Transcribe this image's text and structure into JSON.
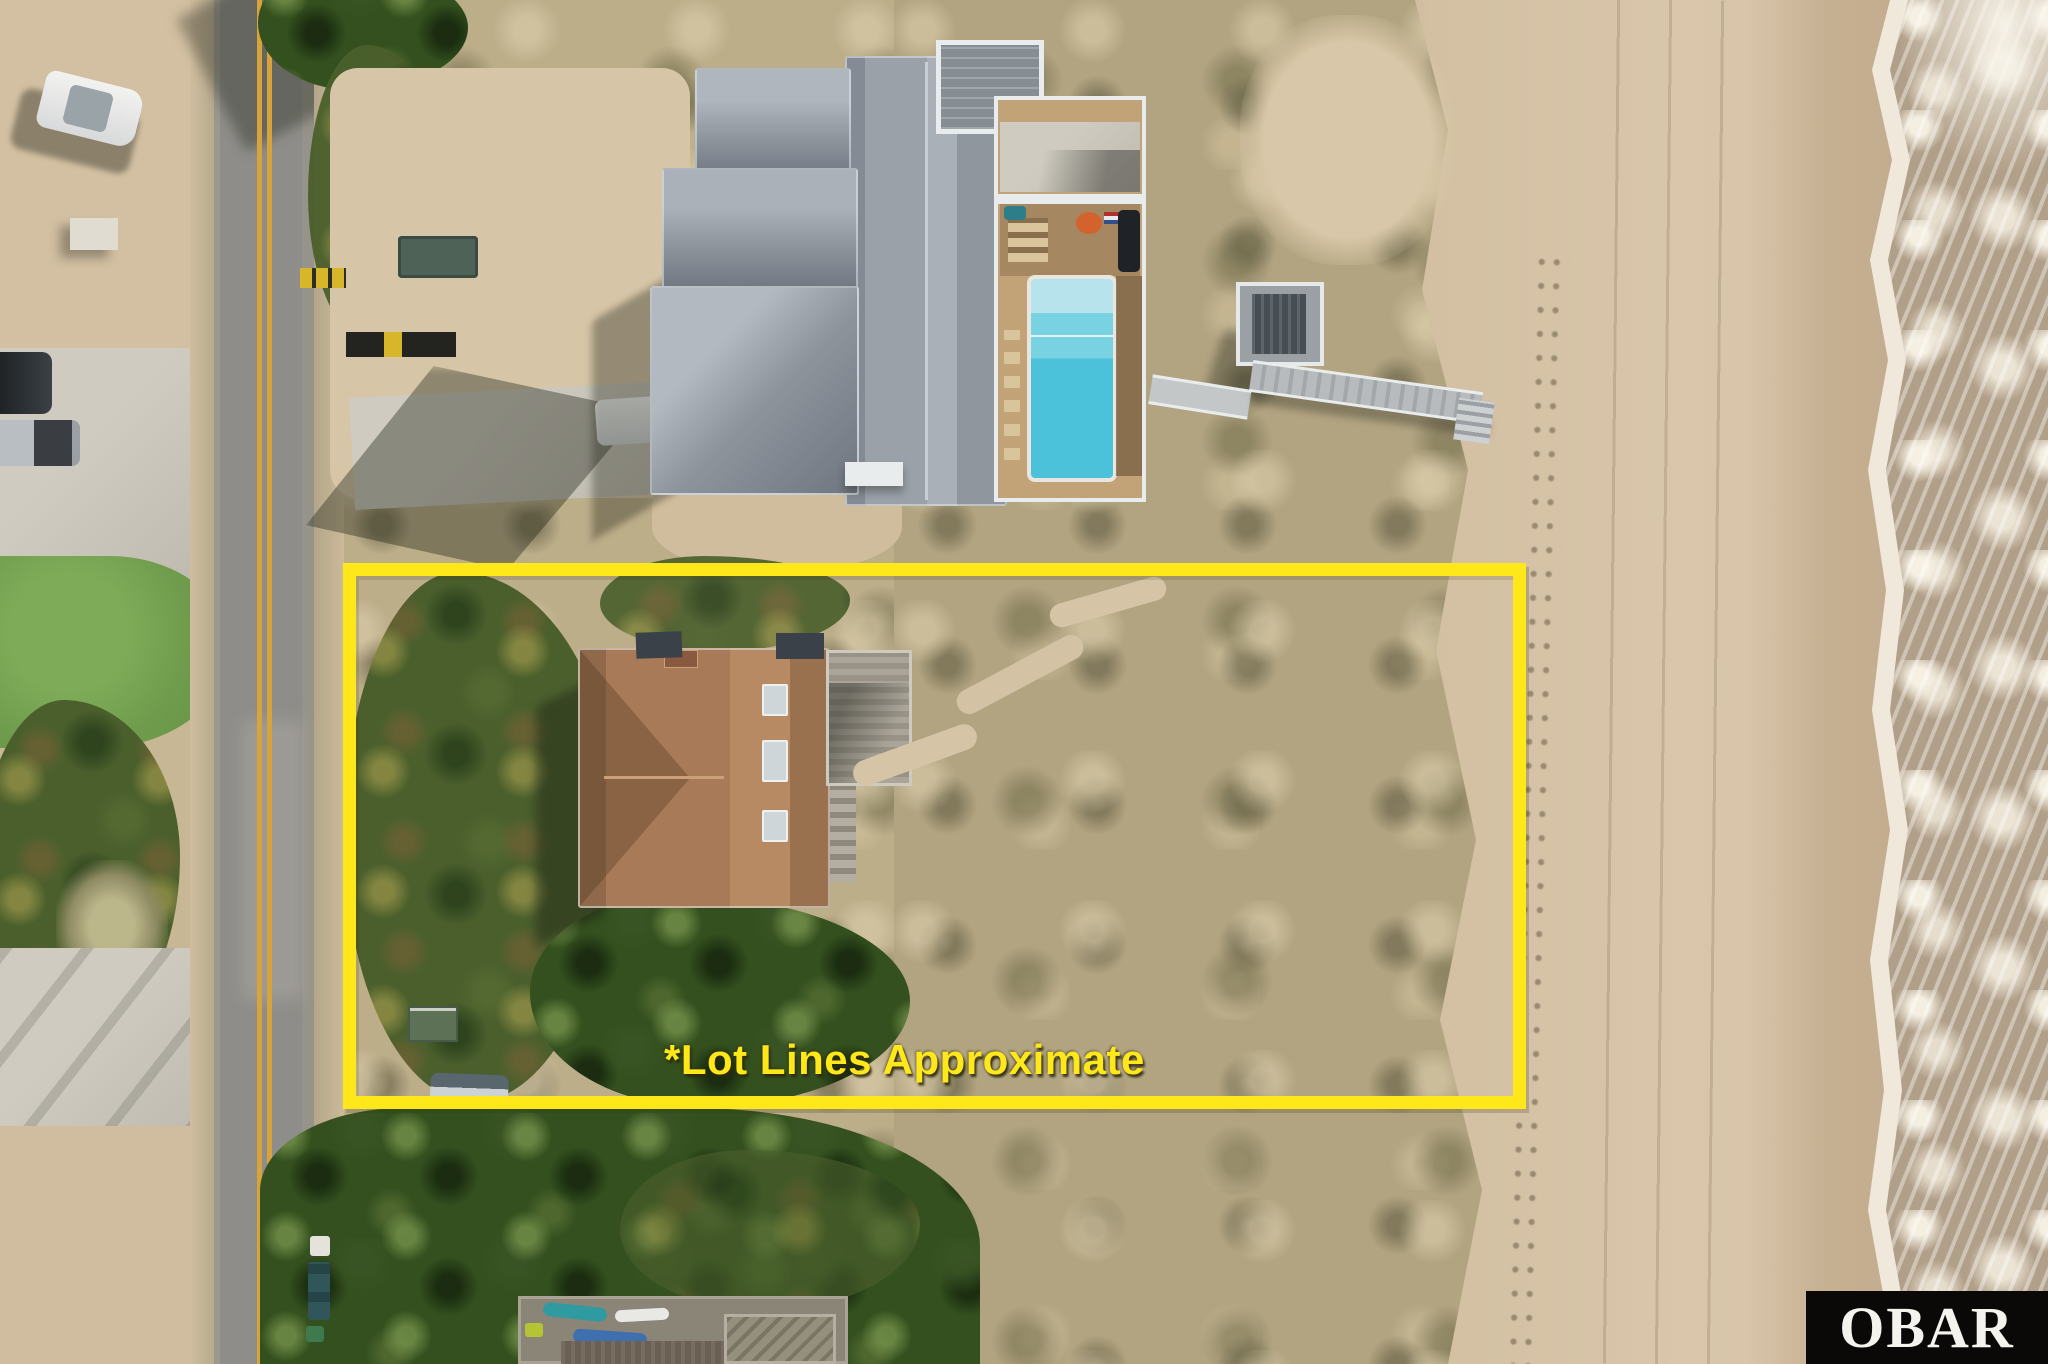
{
  "annotation": {
    "lot_label": "*Lot Lines Approximate",
    "outline_color": "#ffe81a"
  },
  "watermark": {
    "text": "OBAR",
    "background_color": "#0b0907",
    "text_color": "#f5f3ee"
  },
  "colors": {
    "annotation_yellow": "#ffe81a",
    "logo_black": "#0b0907",
    "logo_white": "#f5f3ee",
    "road_line": "#d9a33c",
    "road_asphalt": "#8e8d89",
    "sand_dry": "#d7c4a7",
    "sand_wet": "#c3ac8e",
    "surf_base": "#b1a089",
    "foam_white": "#f2ecdf",
    "concrete": "#c9c5ba",
    "lawn_green": "#6f9c4c",
    "veg_dark": "#33501e",
    "dune_base": "#b2a481",
    "roof_gray": "#9aa1a9",
    "trim_white": "#e9ecec",
    "pool_blue": "#4cc2da",
    "pool_deck_tan": "#c2a377",
    "roof_brown": "#a87a57"
  }
}
